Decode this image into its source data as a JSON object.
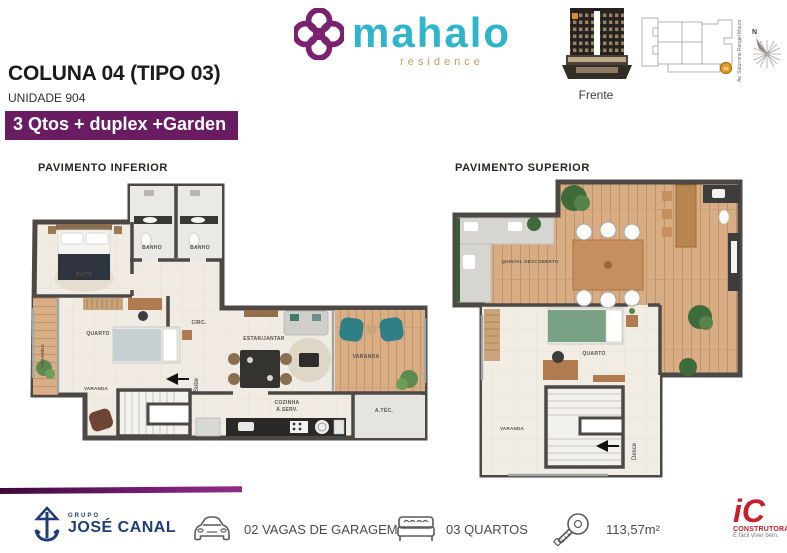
{
  "header": {
    "title": "COLUNA 04 (TIPO 03)",
    "subtitle": "UNIDADE 904",
    "badge": "3 Qtos  + duplex +Garden",
    "brand": {
      "name": "mahalo",
      "tagline": "residence"
    },
    "building_caption": "Frente",
    "site": {
      "street": "Av. Saturnino Rangel Mauro",
      "marker": "04",
      "compass_north": "N"
    }
  },
  "plan_inferior": {
    "title": "PAVIMENTO  INFERIOR",
    "stairs_label": "Sobe",
    "rooms": {
      "suite": "SUITE",
      "banho1": "BANHO",
      "banho2": "BANHO",
      "varanda_suite": "VARANDA",
      "quarto": "QUARTO",
      "circ": "CIRC.",
      "varanda_quarto": "VARANDA",
      "estar": "ESTAR/JANTAR",
      "varanda_estar": "VARANDA",
      "cozinha1": "COZINHA",
      "cozinha2": "Á.SERV.",
      "atec": "A.TÉC."
    }
  },
  "plan_superior": {
    "title": "PAVIMENTO  SUPERIOR",
    "stairs_label": "Desce",
    "rooms": {
      "quintal": "QUINTAL DESCOBERTO",
      "quarto": "QUARTO",
      "varanda": "VARANDA"
    }
  },
  "footer": {
    "grupo": "GRUPO",
    "jose_canal": "JOSÉ CANAL",
    "garagem": "02 VAGAS DE GARAGEM",
    "quartos": "03 QUARTOS",
    "area": "113,57m²",
    "construtora_mark": "iC",
    "construtora": "CONSTRUTORA",
    "construtora_tagline": "É fácil viver bem."
  },
  "colors": {
    "brand_purple": "#7c2170",
    "badge_purple": "#6a1c63",
    "brand_teal": "#2fb5c9",
    "brand_tan": "#c79b5e",
    "jose_canal_blue": "#1e3c7c",
    "ic_red": "#c4202e",
    "wall": "#4c4845"
  }
}
